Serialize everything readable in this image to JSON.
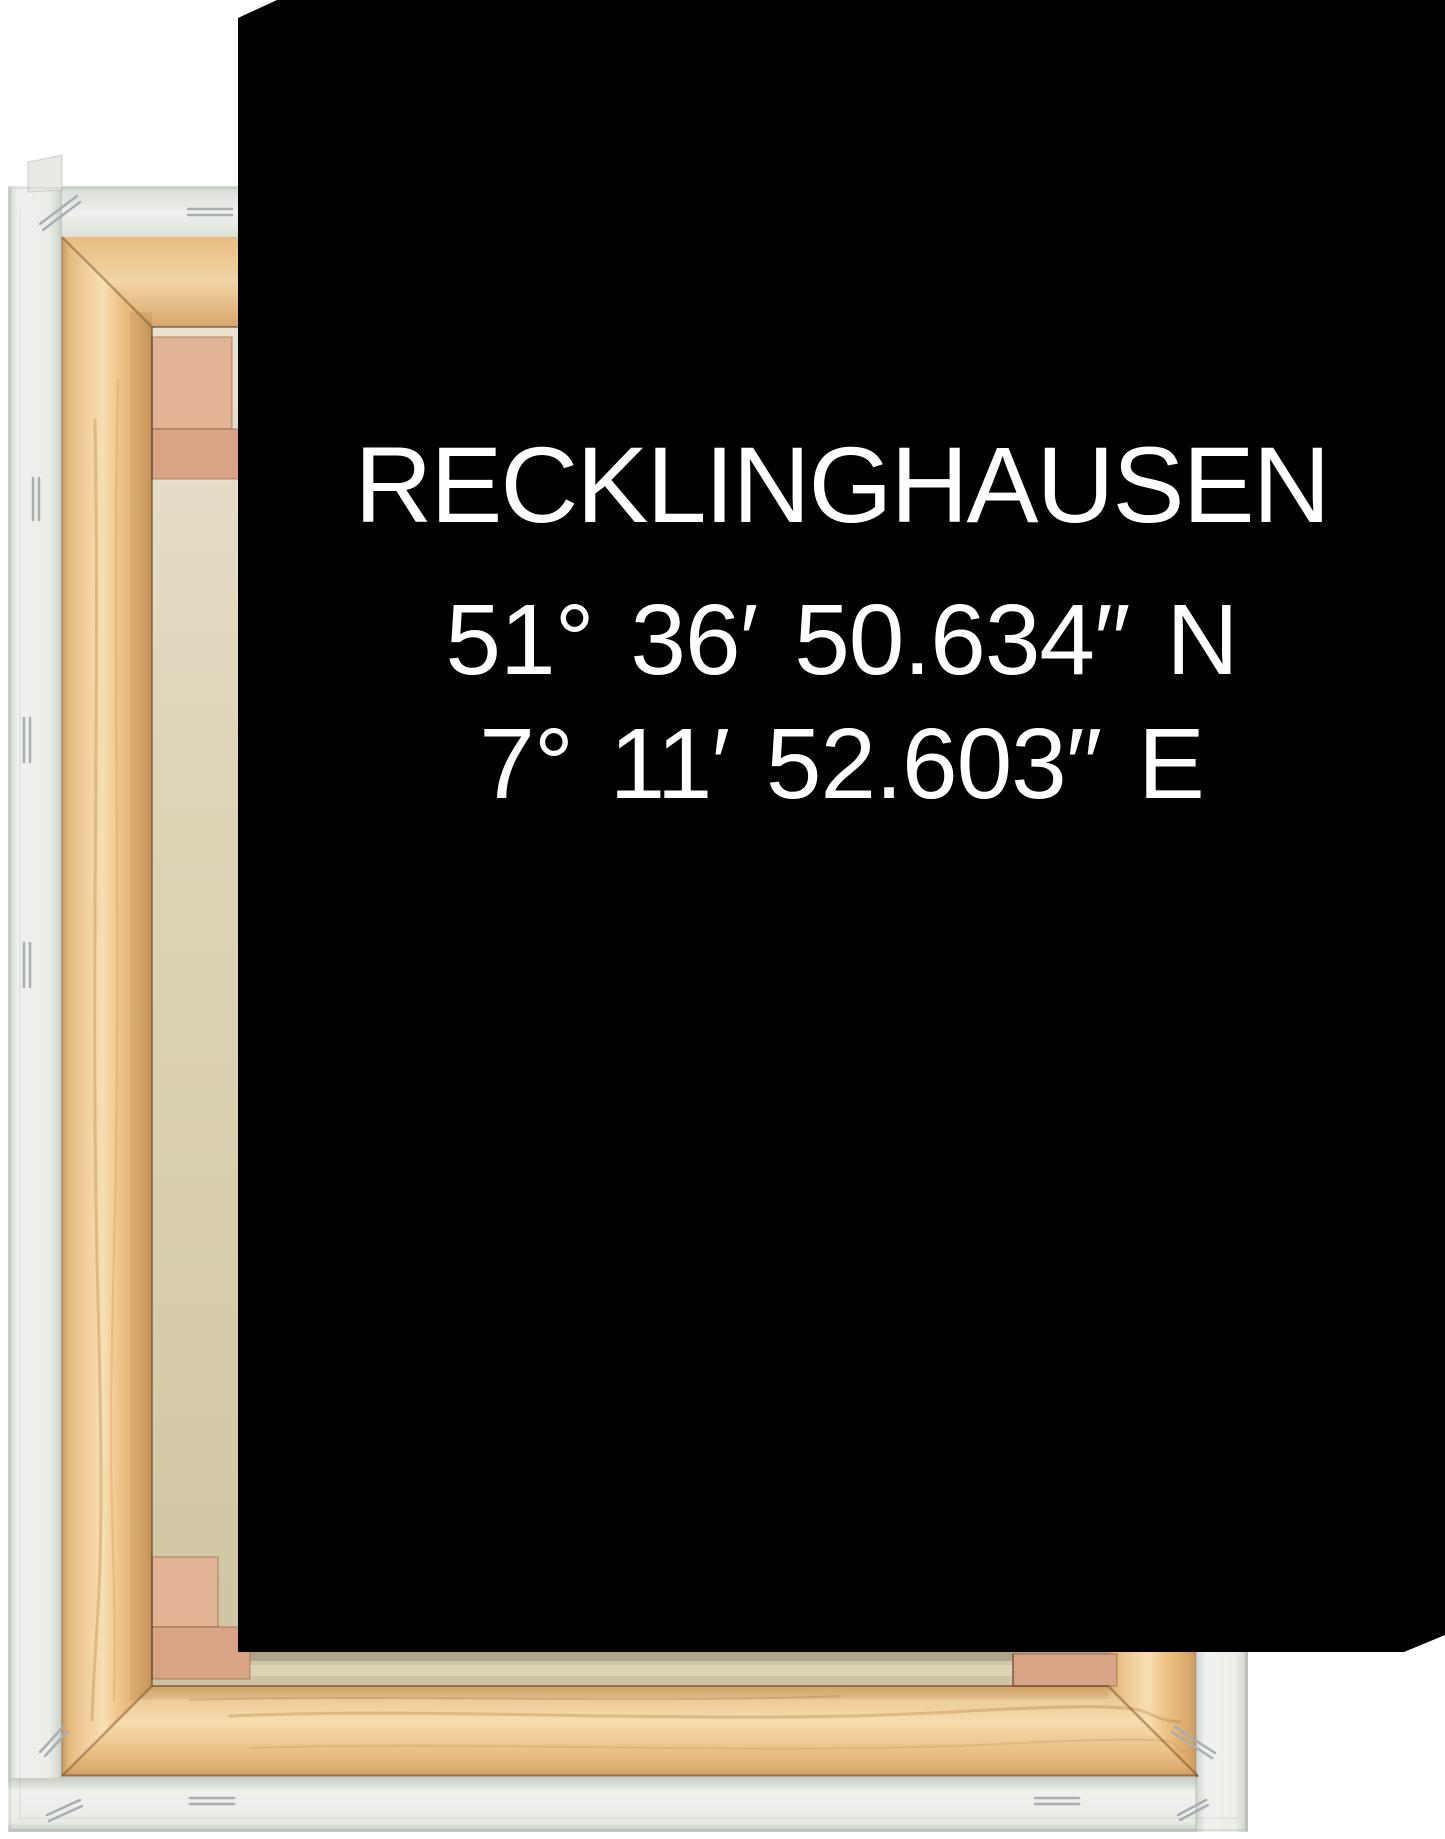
{
  "artwork": {
    "title": "RECKLINGHAUSEN",
    "latitude": "51° 36′ 50.634′′ N",
    "longitude": "7° 11′ 52.603′′ E"
  },
  "colors": {
    "print_background": "#000000",
    "print_text": "#ffffff",
    "page_background": "#ffffff",
    "canvas_back_beige": "#d8cfae",
    "wedge_pink": "#e2b394",
    "wedge_pink_dark": "#d9a486",
    "wood_light": "#f6dcae",
    "wood_mid": "#eabf82",
    "wood_dark": "#c89a60",
    "wrap_white": "#eef1ed",
    "staple_gray": "#a8aeb2"
  }
}
